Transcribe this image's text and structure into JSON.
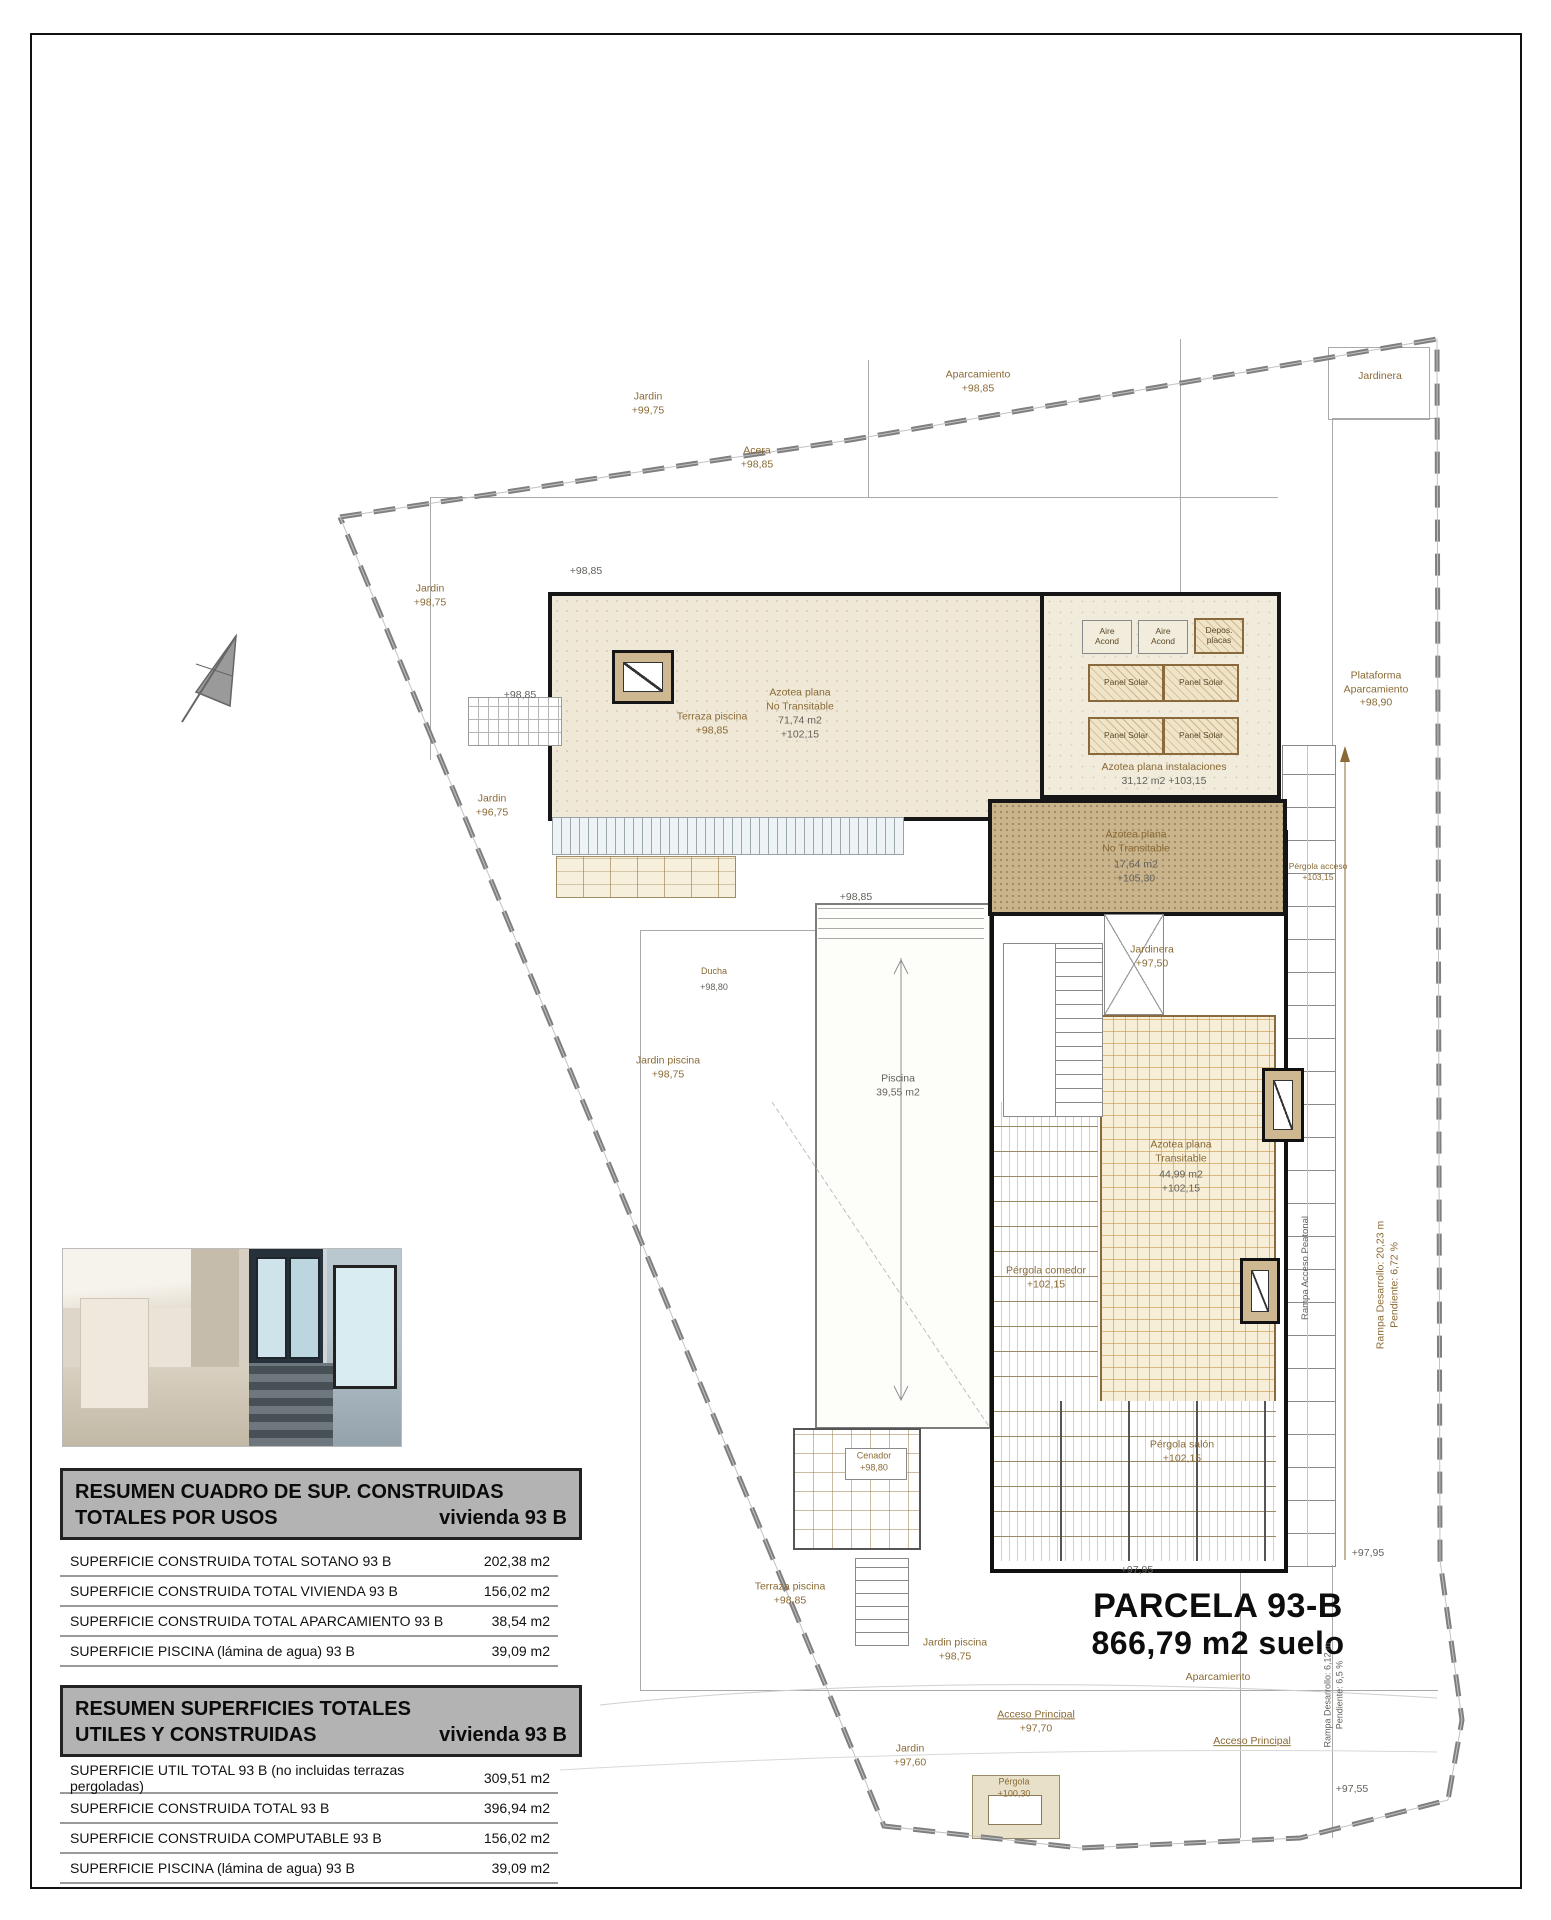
{
  "plan": {
    "labels": [
      {
        "t": [
          "Jardin",
          "+99,75"
        ],
        "x": 648,
        "y": 404
      },
      {
        "t": [
          "Aparcamiento",
          "+98,85"
        ],
        "x": 978,
        "y": 382
      },
      {
        "t": [
          "Jardinera"
        ],
        "x": 1380,
        "y": 377
      },
      {
        "t": [
          "Jardin",
          "+98,75"
        ],
        "x": 430,
        "y": 596
      },
      {
        "t": [
          "Jardin",
          "+96,75"
        ],
        "x": 492,
        "y": 806
      },
      {
        "t": [
          "Acera",
          "+98,85"
        ],
        "x": 757,
        "y": 458
      },
      {
        "t": [
          "+98,85"
        ],
        "x": 586,
        "y": 572,
        "c": "g"
      },
      {
        "t": [
          "+98,85"
        ],
        "x": 520,
        "y": 696,
        "c": "g"
      },
      {
        "t": [
          "Plataforma",
          "Aparcamiento",
          "+98,90"
        ],
        "x": 1376,
        "y": 690
      },
      {
        "t": [
          "Azotea plana",
          "No Transitable"
        ],
        "x": 800,
        "y": 700
      },
      {
        "t": [
          "71,74 m2",
          "+102,15"
        ],
        "x": 800,
        "y": 728,
        "c": "g"
      },
      {
        "t": [
          "Azotea plana  instalaciones"
        ],
        "x": 1164,
        "y": 768
      },
      {
        "t": [
          "31,12 m2      +103,15"
        ],
        "x": 1164,
        "y": 782,
        "c": "g"
      },
      {
        "t": [
          "Azotea plana",
          "No Transitable"
        ],
        "x": 1136,
        "y": 842
      },
      {
        "t": [
          "17,64 m2",
          "+105,30"
        ],
        "x": 1136,
        "y": 872,
        "c": "g"
      },
      {
        "t": [
          "Azotea plana",
          "Transitable"
        ],
        "x": 1181,
        "y": 1152
      },
      {
        "t": [
          "44,99 m2",
          "+102,15"
        ],
        "x": 1181,
        "y": 1182,
        "c": "g"
      },
      {
        "t": [
          "Pérgola comedor",
          "+102,15"
        ],
        "x": 1046,
        "y": 1278
      },
      {
        "t": [
          "Pérgola salón",
          "+102,15"
        ],
        "x": 1182,
        "y": 1452
      },
      {
        "t": [
          "Jardinera",
          "+97,50"
        ],
        "x": 1152,
        "y": 957
      },
      {
        "t": [
          "Pérgola acceso",
          "+103,15"
        ],
        "x": 1318,
        "y": 872,
        "s": 8.5
      },
      {
        "t": [
          "Terraza piscina",
          "+98,85"
        ],
        "x": 712,
        "y": 724
      },
      {
        "t": [
          "+98,85"
        ],
        "x": 856,
        "y": 898,
        "c": "g"
      },
      {
        "t": [
          "Ducha"
        ],
        "x": 714,
        "y": 972,
        "s": 9
      },
      {
        "t": [
          "+98,80"
        ],
        "x": 714,
        "y": 988,
        "c": "g",
        "s": 9
      },
      {
        "t": [
          "Jardin piscina",
          "+98,75"
        ],
        "x": 668,
        "y": 1068
      },
      {
        "t": [
          "Piscina",
          "39,55 m2"
        ],
        "x": 898,
        "y": 1086,
        "c": "g"
      },
      {
        "t": [
          "Rampa Acceso Peatonal"
        ],
        "x": 1306,
        "y": 1268,
        "r": -90,
        "c": "g",
        "s": 9.5
      },
      {
        "t": [
          "Rampa Desarrollo: 20,23 m",
          "Pendiente: 6,72 %"
        ],
        "x": 1388,
        "y": 1285,
        "r": -90
      },
      {
        "t": [
          "+97,95"
        ],
        "x": 1137,
        "y": 1571,
        "c": "g"
      },
      {
        "t": [
          "+97,95"
        ],
        "x": 1368,
        "y": 1554,
        "c": "g"
      },
      {
        "t": [
          "PARCELA  93-B"
        ],
        "x": 1218,
        "y": 1606,
        "c": "k",
        "s": 34,
        "bold": true
      },
      {
        "t": [
          "866,79 m2 suelo"
        ],
        "x": 1218,
        "y": 1644,
        "c": "k",
        "s": 32,
        "bold": true
      },
      {
        "t": [
          "Aparcamiento"
        ],
        "x": 1218,
        "y": 1678
      },
      {
        "t": [
          "Rampa Desarrollo: 6,12 m",
          "Pendiente: 6,5 %"
        ],
        "x": 1334,
        "y": 1695,
        "r": -90,
        "c": "g",
        "s": 9
      },
      {
        "t": [
          "Acceso Principal",
          "+97,70"
        ],
        "x": 1036,
        "y": 1722,
        "u": true
      },
      {
        "t": [
          "Acceso Principal"
        ],
        "x": 1252,
        "y": 1742,
        "u": true
      },
      {
        "t": [
          "Jardin",
          "+97,60"
        ],
        "x": 910,
        "y": 1756
      },
      {
        "t": [
          "Pérgola",
          "+100,30"
        ],
        "x": 1014,
        "y": 1788,
        "s": 9
      },
      {
        "t": [
          "+97,55"
        ],
        "x": 1352,
        "y": 1790,
        "c": "g"
      },
      {
        "t": [
          "Jardin piscina",
          "+98,75"
        ],
        "x": 955,
        "y": 1650
      },
      {
        "t": [
          "Terraza piscina",
          "+98,85"
        ],
        "x": 790,
        "y": 1594
      },
      {
        "t": [
          "Cenador",
          "+98,80"
        ],
        "x": 874,
        "y": 1462,
        "s": 9
      }
    ],
    "boxes": [
      {
        "label": [
          "Aire",
          "Acond"
        ],
        "x": 1082,
        "y": 620,
        "w": 48,
        "h": 32,
        "style": "plain"
      },
      {
        "label": [
          "Aire",
          "Acond"
        ],
        "x": 1138,
        "y": 620,
        "w": 48,
        "h": 32,
        "style": "plain"
      },
      {
        "label": [
          "Depos.",
          "placas"
        ],
        "x": 1194,
        "y": 618,
        "w": 46,
        "h": 32,
        "style": "hatch"
      },
      {
        "label": [
          "Panel Solar"
        ],
        "x": 1088,
        "y": 664,
        "w": 72,
        "h": 34,
        "style": "hatch"
      },
      {
        "label": [
          "Panel Solar"
        ],
        "x": 1163,
        "y": 664,
        "w": 72,
        "h": 34,
        "style": "hatch"
      },
      {
        "label": [
          "Panel Solar"
        ],
        "x": 1088,
        "y": 717,
        "w": 72,
        "h": 34,
        "style": "hatch"
      },
      {
        "label": [
          "Panel Solar"
        ],
        "x": 1163,
        "y": 717,
        "w": 72,
        "h": 34,
        "style": "hatch"
      }
    ]
  },
  "tables": [
    {
      "title_line1": "RESUMEN CUADRO DE SUP. CONSTRUIDAS",
      "title_line2": "TOTALES POR USOS",
      "title_right": "vivienda 93 B",
      "rows": [
        {
          "label": "SUPERFICIE CONSTRUIDA TOTAL  SOTANO  93 B",
          "value": "202,38 m2"
        },
        {
          "label": "SUPERFICIE CONSTRUIDA TOTAL VIVIENDA 93 B",
          "value": "156,02 m2"
        },
        {
          "label": "SUPERFICIE CONSTRUIDA TOTAL APARCAMIENTO  93 B",
          "value": "38,54 m2"
        },
        {
          "label": "SUPERFICIE PISCINA (lámina de agua)  93 B",
          "value": "39,09 m2"
        }
      ]
    },
    {
      "title_line1": "RESUMEN SUPERFICIES TOTALES",
      "title_line2": "UTILES Y CONSTRUIDAS",
      "title_right": "vivienda 93 B",
      "rows": [
        {
          "label": "SUPERFICIE UTIL TOTAL   93 B (no incluidas terrazas pergoladas)",
          "value": "309,51 m2"
        },
        {
          "label": "SUPERFICIE CONSTRUIDA TOTAL  93 B",
          "value": "396,94 m2"
        },
        {
          "label": "SUPERFICIE CONSTRUIDA COMPUTABLE  93 B",
          "value": "156,02 m2"
        },
        {
          "label": "SUPERFICIE PISCINA (lámina de agua)  93 B",
          "value": "39,09 m2"
        }
      ]
    }
  ],
  "colors": {
    "label_brown": "#8a6a35",
    "label_gray": "#64615c",
    "building_fill": "#efe8d6",
    "annex_fill": "#c9b48c",
    "tile_line": "#d9a85c",
    "header_bg": "#b3b3b3",
    "boundary_gray": "#7f7f7f"
  }
}
